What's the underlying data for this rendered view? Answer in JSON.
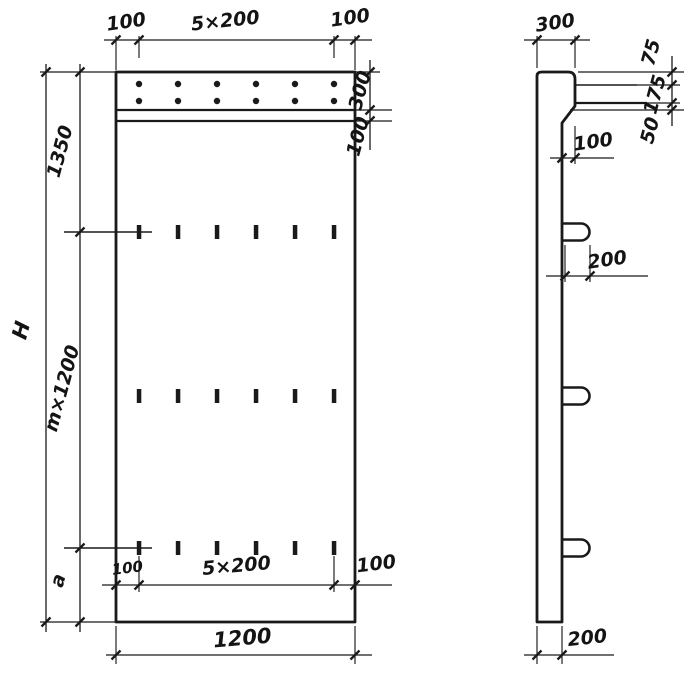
{
  "front_view": {
    "top_dims": {
      "left": "100",
      "center": "5×200",
      "right": "100"
    },
    "right_dims": {
      "cap_height": "300",
      "below_cap": "100"
    },
    "left_dims": {
      "overall_height": "H",
      "top_segment": "1350",
      "middle_segment": "m×1200",
      "bottom_segment": "a"
    },
    "bottom_inner_dims": {
      "left": "100",
      "center": "5×200",
      "right": "100"
    },
    "overall_width": "1200"
  },
  "side_view": {
    "cap_width": "300",
    "right_chain": {
      "top": "75",
      "middle": "175",
      "bottom": "50"
    },
    "face_offset": "100",
    "loop_length": "200",
    "panel_thickness": "200"
  }
}
